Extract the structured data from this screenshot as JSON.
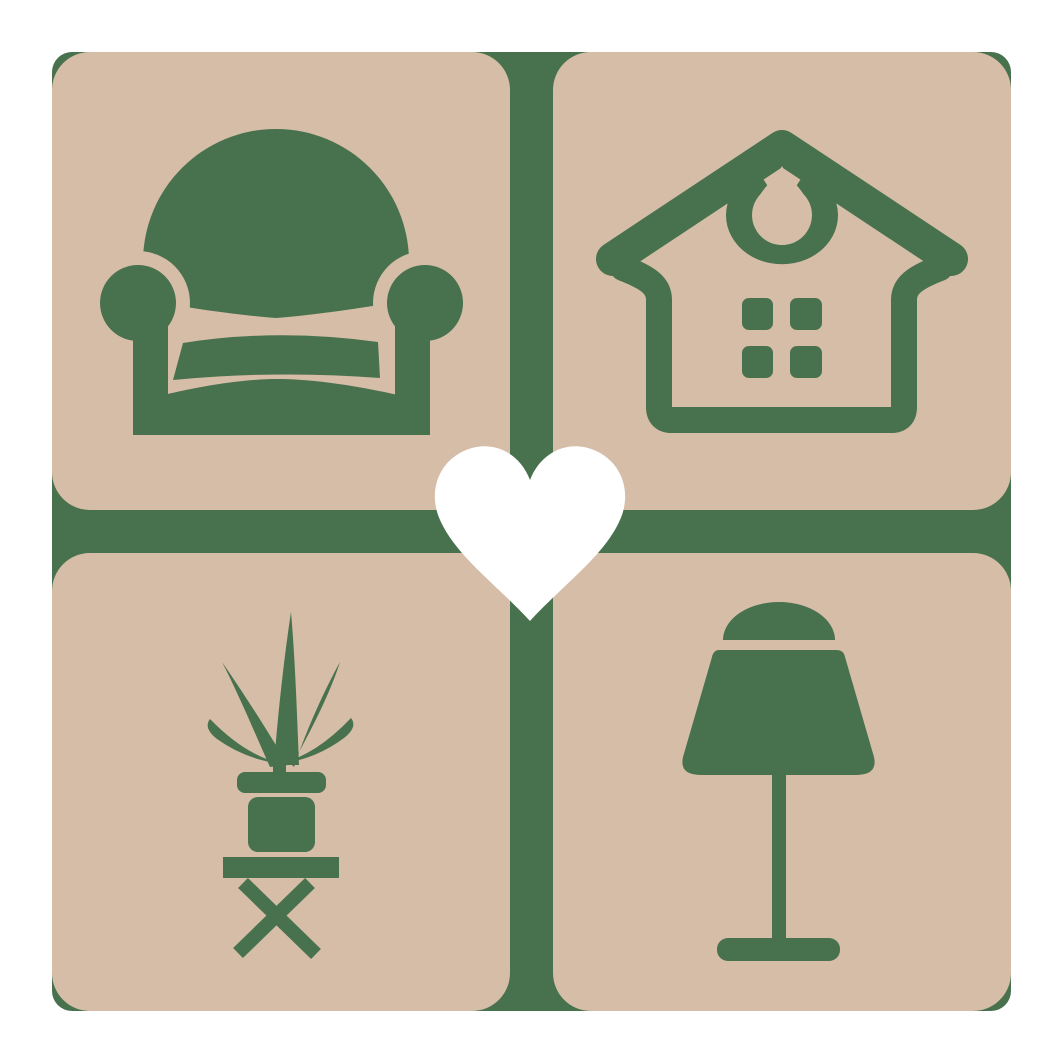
{
  "logo": {
    "colors": {
      "green": "#48714e",
      "beige": "#d5bda7",
      "heart": "#ffffff",
      "background": "#ffffff"
    },
    "tiles": [
      {
        "position": "top-left",
        "icon": "armchair-icon"
      },
      {
        "position": "top-right",
        "icon": "house-icon"
      },
      {
        "position": "bottom-left",
        "icon": "potted-plant-icon"
      },
      {
        "position": "bottom-right",
        "icon": "table-lamp-icon"
      }
    ],
    "center": {
      "icon": "heart-icon"
    }
  }
}
